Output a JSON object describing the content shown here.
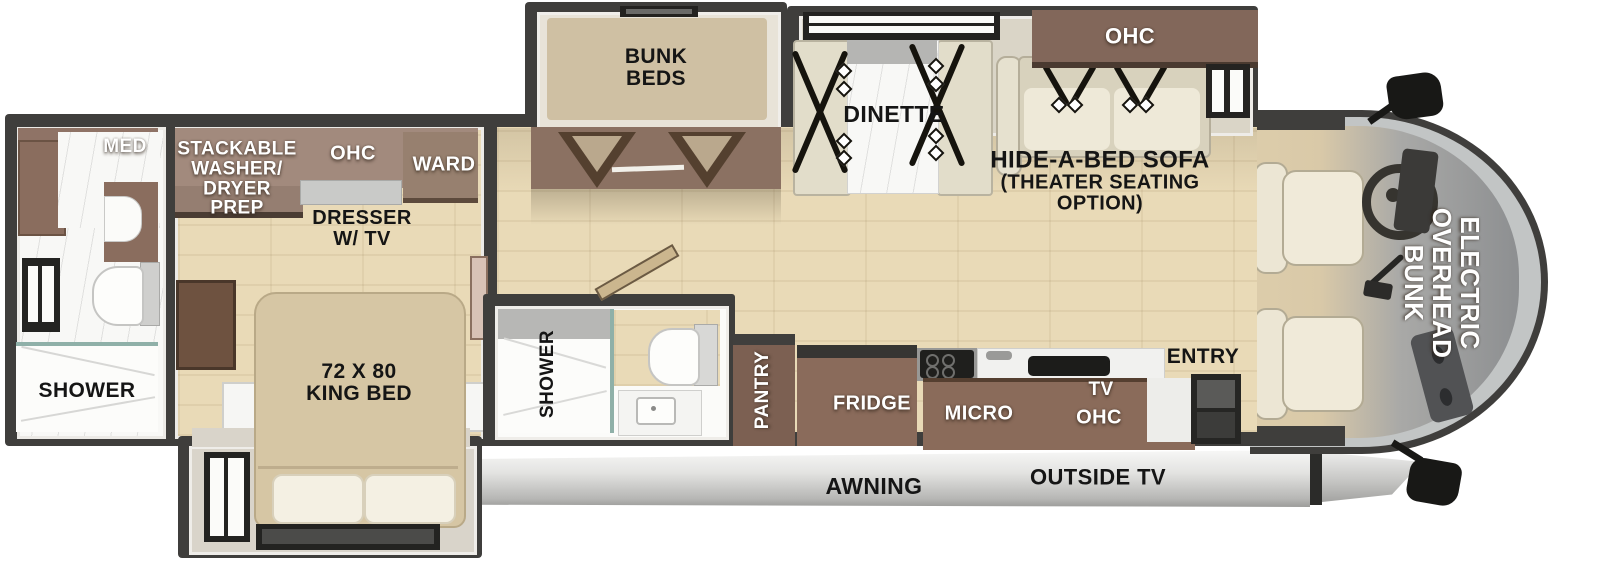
{
  "title": "Motorhome floorplan",
  "colors": {
    "wall": "#3f3e3c",
    "floor_wood": "#e9dab7",
    "cabinet_brown": "#8a6b5a",
    "bed_tan": "#d6c6a4",
    "cream_seat": "#e6e1cf",
    "awning_gray": "#d9d9d7",
    "glass_gray": "#c2c5c5",
    "label_black": "#151515",
    "label_white": "#ffffff"
  },
  "labels": {
    "rear_bath": {
      "med": "MED",
      "shower": "SHOWER"
    },
    "bedroom": {
      "washer_dryer": [
        "STACKABLE",
        "WASHER/",
        "DRYER",
        "PREP"
      ],
      "ohc": "OHC",
      "ward": "WARD",
      "dresser": [
        "DRESSER",
        "W/ TV"
      ],
      "king_bed": [
        "72 X 80",
        "KING BED"
      ]
    },
    "bunk_room": {
      "bunk_beds": [
        "BUNK",
        "BEDS"
      ]
    },
    "mid_bath": {
      "shower": "SHOWER"
    },
    "dinette": {
      "name": "DINETTE"
    },
    "living": {
      "sofa": [
        "HIDE-A-BED SOFA",
        "(THEATER SEATING",
        "OPTION)"
      ],
      "ohc": "OHC"
    },
    "kitchen": {
      "pantry": "PANTRY",
      "fridge": "FRIDGE",
      "micro": "MICRO",
      "tv": "TV",
      "ohc": "OHC",
      "entry": "ENTRY"
    },
    "cab": {
      "overhead_bunk": [
        "ELECTRIC",
        "OVERHEAD",
        "BUNK"
      ]
    },
    "exterior": {
      "awning": "AWNING",
      "outside_tv": "OUTSIDE TV"
    }
  }
}
